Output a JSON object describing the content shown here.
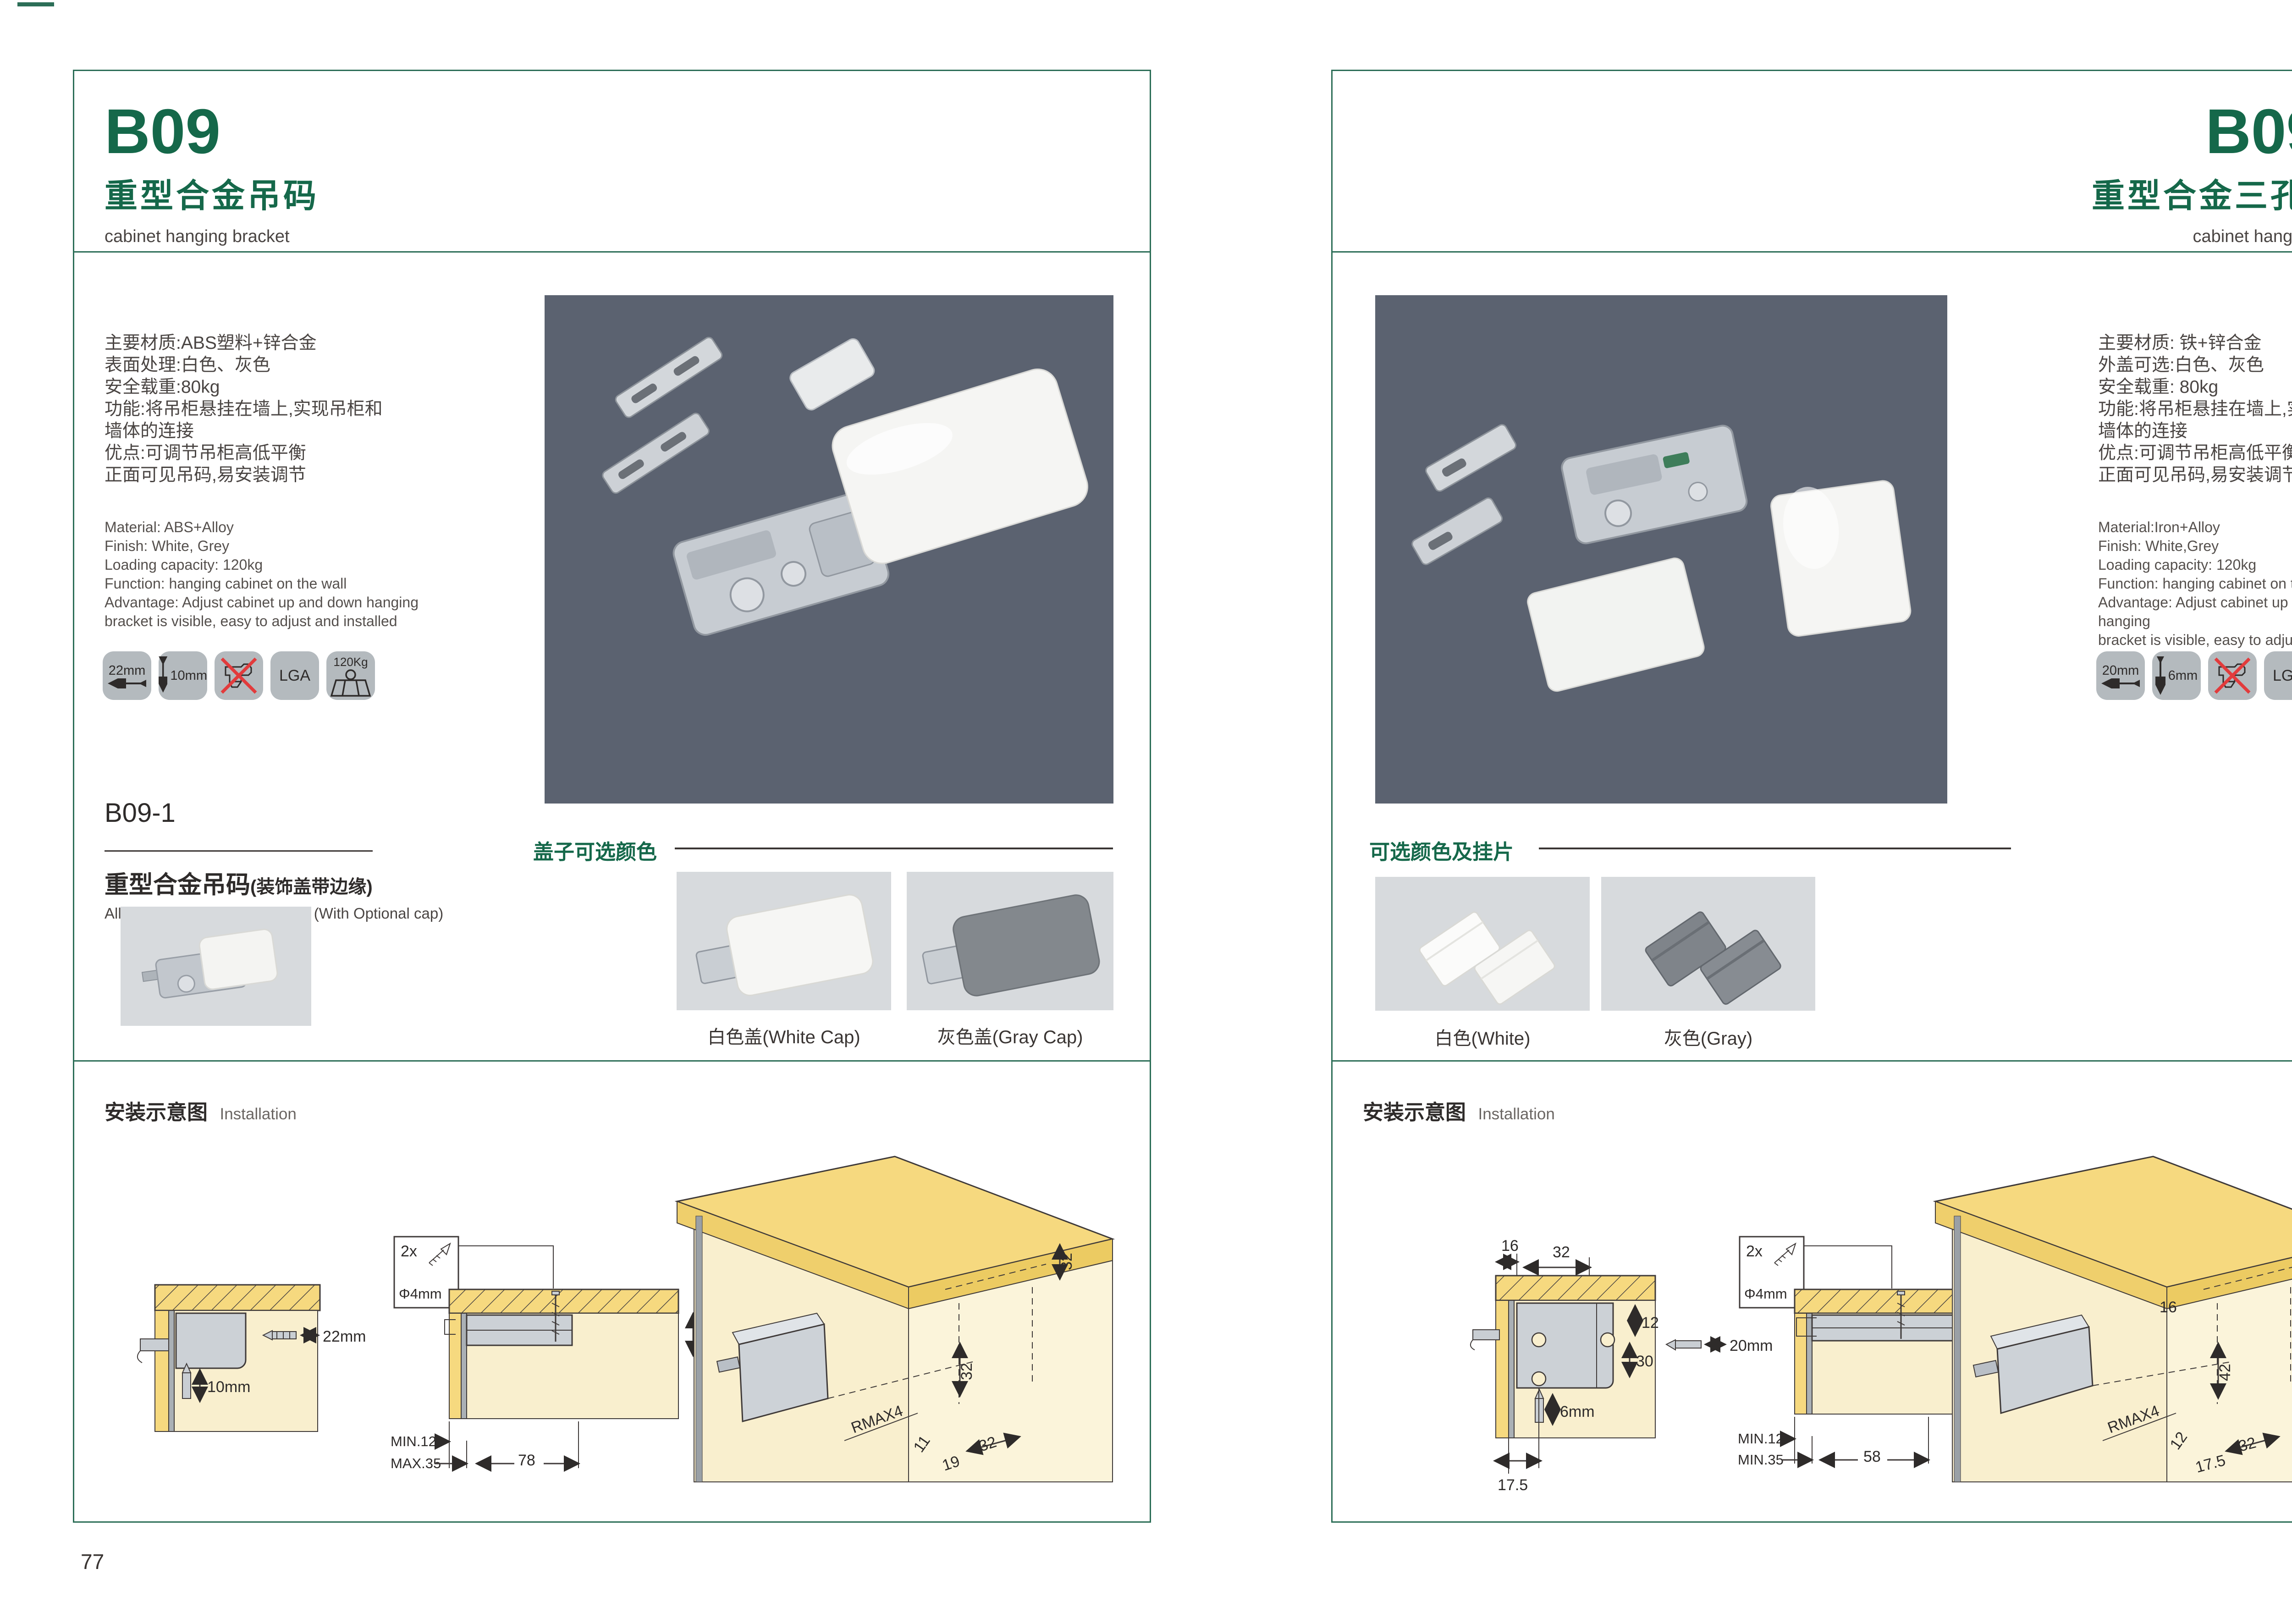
{
  "brand_color": "#15684a",
  "left_page": {
    "code": "B09",
    "title_cn": "重型合金吊码",
    "title_en": "cabinet hanging bracket",
    "spec_cn_lines": [
      "主要材质:ABS塑料+锌合金",
      "表面处理:白色、灰色",
      "安全载重:80kg",
      "功能:将吊柜悬挂在墙上,实现吊柜和",
      "墙体的连接",
      "优点:可调节吊柜高低平衡",
      "正面可见吊码,易安装调节"
    ],
    "spec_en_lines": [
      "Material: ABS+Alloy",
      "Finish: White, Grey",
      "Loading capacity: 120kg",
      "Function: hanging cabinet on the wall",
      "Advantage: Adjust cabinet up and down hanging",
      "bracket is visible, easy to adjust and installed"
    ],
    "icons": {
      "width": "22mm",
      "height": "10mm",
      "cert": "LGA",
      "load": "120Kg"
    },
    "sub_section": {
      "code": "B09-1",
      "title_cn": "重型合金吊码",
      "title_cn_suffix": "(装饰盖带边缘)",
      "title_en": "Alloy Cabinet Hanging Bracket (With Optional cap)"
    },
    "caps": {
      "heading": "盖子可选颜色",
      "white_caption": "白色盖(White Cap)",
      "gray_caption": "灰色盖(Gray Cap)"
    },
    "install": {
      "heading_cn": "安装示意图",
      "heading_en": "Installation",
      "d1": {
        "width": "22mm",
        "depth": "10mm"
      },
      "d2": {
        "qty": "2x",
        "dia": "Φ4mm",
        "side": "13",
        "min": "MIN.12",
        "max": "MAX.35",
        "len": "78"
      },
      "d3": {
        "top": "32",
        "mid": "32",
        "radius": "RMAX4",
        "a": "11",
        "b": "19",
        "c": "32"
      }
    },
    "page_no": "77"
  },
  "right_page": {
    "code": "B09-3",
    "title_cn": "重型合金三孔吊码",
    "title_en": "cabinet hanging bracket",
    "spec_cn_lines": [
      "主要材质: 铁+锌合金",
      "外盖可选:白色、灰色",
      "安全载重: 80kg",
      "功能:将吊柜悬挂在墙上,实现吊柜和",
      "墙体的连接",
      "优点:可调节吊柜高低平衡",
      "正面可见吊码,易安装调节"
    ],
    "spec_en_lines": [
      "Material:Iron+Alloy",
      "Finish: White,Grey",
      "Loading capacity: 120kg",
      "Function: hanging cabinet on the wall",
      "Advantage: Adjust cabinet up and down hanging",
      "bracket is visible, easy to adjust and installed"
    ],
    "icons": {
      "width": "20mm",
      "height": "6mm",
      "cert": "LGA",
      "load": "120Kg"
    },
    "caps": {
      "heading": "可选颜色及挂片",
      "white_caption": "白色(White)",
      "gray_caption": "灰色(Gray)"
    },
    "install": {
      "heading_cn": "安装示意图",
      "heading_en": "Installation",
      "d1": {
        "a": "16",
        "b": "32",
        "c": "12",
        "d": "30",
        "width": "20mm",
        "depth": "6mm",
        "e": "17.5"
      },
      "d2": {
        "qty": "2x",
        "dia": "Φ4mm",
        "side": "12",
        "min": "MIN.12",
        "max": "MIN.35",
        "len": "58"
      },
      "d3": {
        "top": "12",
        "a": "16",
        "b": "42",
        "radius": "RMAX4",
        "c": "12",
        "d": "17.5",
        "e": "32"
      }
    },
    "page_no": "78"
  }
}
